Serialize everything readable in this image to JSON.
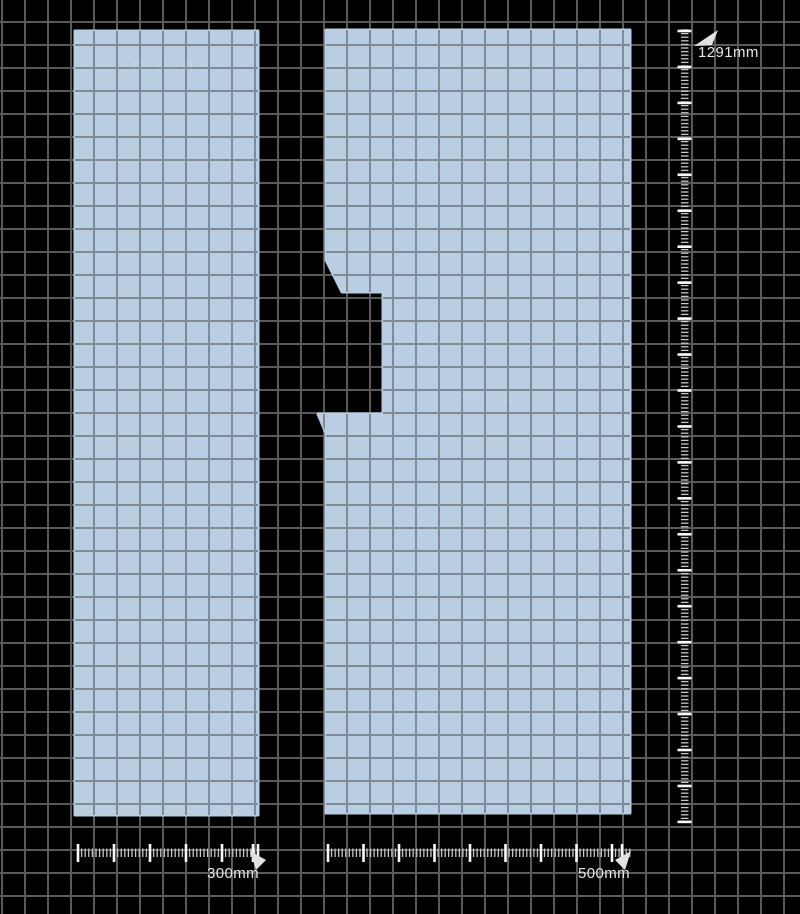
{
  "canvas": {
    "background_color": "#000000",
    "grid_color": "#5a5a5a",
    "panel_fill_color": "#b9cee2",
    "panel_grid_color": "#7e8a94",
    "tick_minor_color": "#c9c9c9",
    "tick_major_color": "#fafafa",
    "flag_color": "#e2e2e2"
  },
  "measurements": {
    "height_label": "1291mm",
    "left_width_label": "300mm",
    "right_width_label": "500mm"
  },
  "panels": [
    {
      "name": "left-panel",
      "watermark": "300 x 1291"
    },
    {
      "name": "right-panel",
      "watermark": "500 x 1291"
    }
  ]
}
